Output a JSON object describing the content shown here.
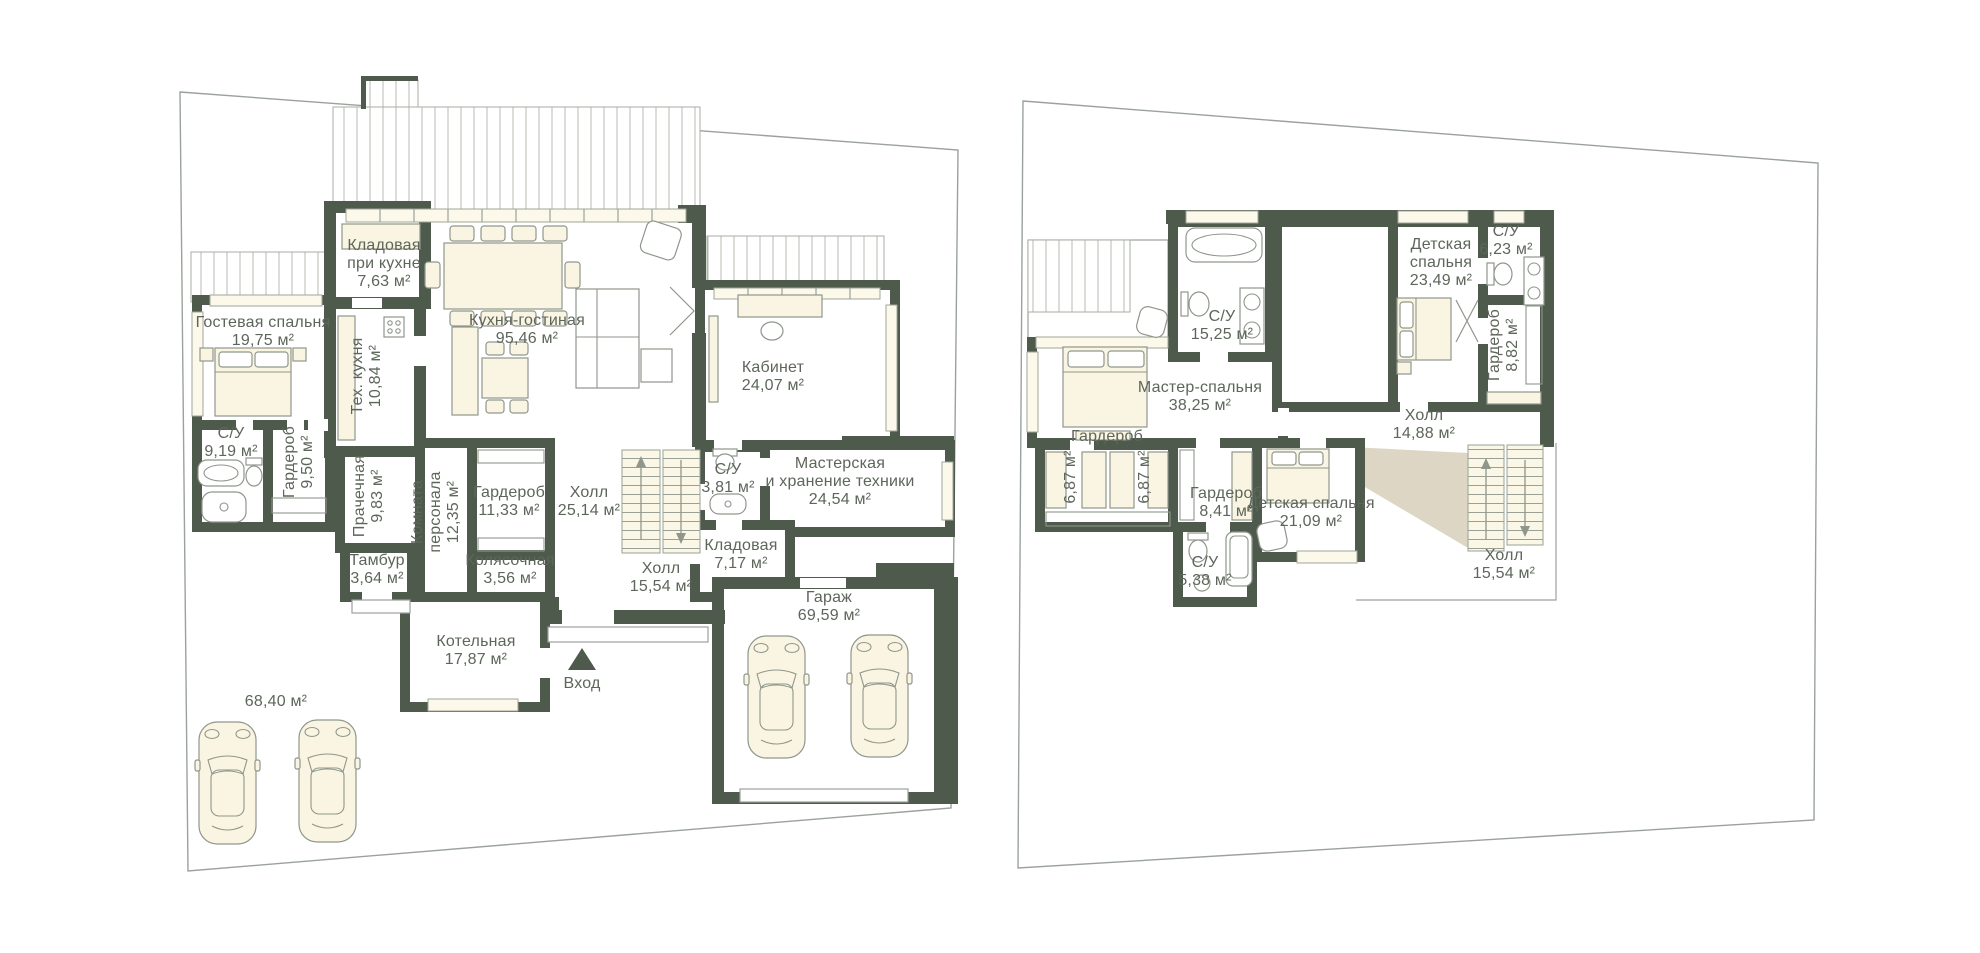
{
  "colors": {
    "wall": "#4e5a4c",
    "furniture_fill": "#faf5e2",
    "outline": "#8f968b",
    "hatch_line": "#b6bbb2",
    "shadow": "#ddd6c4",
    "label_text": "#5d665a",
    "lot_line": "#9aa29b",
    "background": "#ffffff"
  },
  "floor1": {
    "entrance_label": "Вход",
    "yard_area_label": "68,40 м²",
    "rooms": {
      "pantry_kitchen": {
        "name1": "Кладовая",
        "name2": "при кухне",
        "area": "7,63 м²"
      },
      "tech_kitchen": {
        "name": "Тех. кухня",
        "area": "10,84 м²"
      },
      "kitchen_living": {
        "name": "Кухня-гостиная",
        "area": "95,46 м²"
      },
      "guest_bedroom": {
        "name": "Гостевая спальня",
        "area": "19,75 м²"
      },
      "guest_bath": {
        "name": "С/У",
        "area": "9,19 м²"
      },
      "guest_wardrobe": {
        "name": "Гардероб",
        "area": "9,50 м²"
      },
      "laundry": {
        "name": "Прачечная",
        "area": "9,83 м²"
      },
      "staff_room": {
        "name1": "Комната",
        "name2": "персонала",
        "area": "12,35 м²"
      },
      "wardrobe_main": {
        "name": "Гардероб",
        "area": "11,33 м²"
      },
      "tambour": {
        "name": "Тамбур",
        "area": "3,64 м²"
      },
      "stroller_room": {
        "name": "Колясочная",
        "area": "3,56 м²"
      },
      "hall_main": {
        "name": "Холл",
        "area": "25,14 м²"
      },
      "hall_bath": {
        "name": "С/У",
        "area": "3,81 м²"
      },
      "cabinet": {
        "name": "Кабинет",
        "area": "24,07 м²"
      },
      "workshop": {
        "name1": "Мастерская",
        "name2": "и хранение техники",
        "area": "24,54 м²"
      },
      "storage": {
        "name": "Кладовая",
        "area": "7,17 м²"
      },
      "hall_entry": {
        "name": "Холл",
        "area": "15,54 м²"
      },
      "boiler_room": {
        "name": "Котельная",
        "area": "17,87 м²"
      },
      "garage": {
        "name": "Гараж",
        "area": "69,59 м²"
      }
    }
  },
  "floor2": {
    "rooms": {
      "master_bath": {
        "name": "С/У",
        "area": "15,25 м²"
      },
      "master_bedroom": {
        "name": "Мастер-спальня",
        "area": "38,25 м²"
      },
      "master_wardrobe": {
        "name": "Гардероб",
        "area_left": "6,87 м²",
        "area_right": "6,87 м²"
      },
      "kids_bedroom1": {
        "name1": "Детская",
        "name2": "спальня",
        "area": "23,49 м²"
      },
      "kids_bath1": {
        "name": "С/У",
        "area": "6,23 м²"
      },
      "kids_wardrobe1": {
        "name": "Гардероб",
        "area": "8,82 м²"
      },
      "hall": {
        "name": "Холл",
        "area": "14,88 м²"
      },
      "kids_wardrobe2": {
        "name": "Гардероб",
        "area": "8,41 м²"
      },
      "kids_bedroom2": {
        "name": "Детская спальня",
        "area": "21,09 м²"
      },
      "kids_bath2": {
        "name": "С/У",
        "area": "5,38 м²"
      },
      "hall_stairs": {
        "name": "Холл",
        "area": "15,54 м²"
      }
    }
  }
}
